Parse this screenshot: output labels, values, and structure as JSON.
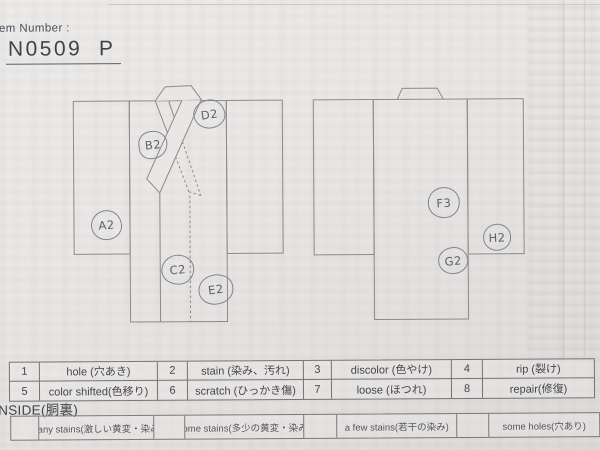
{
  "header": {
    "item_number_label": "Item Number :",
    "item_number_value": "N0509  P"
  },
  "marks": {
    "front": [
      {
        "label": "A2"
      },
      {
        "label": "B2"
      },
      {
        "label": "C2"
      },
      {
        "label": "D2"
      },
      {
        "label": "E2"
      }
    ],
    "back": [
      {
        "label": "F3"
      },
      {
        "label": "G2"
      },
      {
        "label": "H2"
      }
    ]
  },
  "codes_table": {
    "rows": [
      {
        "cells": [
          {
            "num": "1",
            "label": "hole (穴あき)"
          },
          {
            "num": "2",
            "label": "stain (染み、汚れ)"
          },
          {
            "num": "3",
            "label": "discolor (色やけ)"
          },
          {
            "num": "4",
            "label": "rip (裂け)"
          }
        ]
      },
      {
        "cells": [
          {
            "num": "5",
            "label": "color shifted(色移り)"
          },
          {
            "num": "6",
            "label": "scratch (ひっかき傷)"
          },
          {
            "num": "7",
            "label": "loose (ほつれ)"
          },
          {
            "num": "8",
            "label": "repair(修復)"
          }
        ]
      }
    ]
  },
  "inside": {
    "section_label": "INSIDE(胴裏)",
    "options": [
      {
        "label": "many stains(激しい黄変・染み)"
      },
      {
        "label": "some stains(多少の黄変・染み)"
      },
      {
        "label": "a few stains(若干の染み)"
      },
      {
        "label": "some holes(穴あり)"
      }
    ]
  },
  "colors": {
    "paper": "#e9e7e5",
    "outline": "#8d8b89",
    "ink": "#46474b",
    "pencil": "#83838a"
  }
}
